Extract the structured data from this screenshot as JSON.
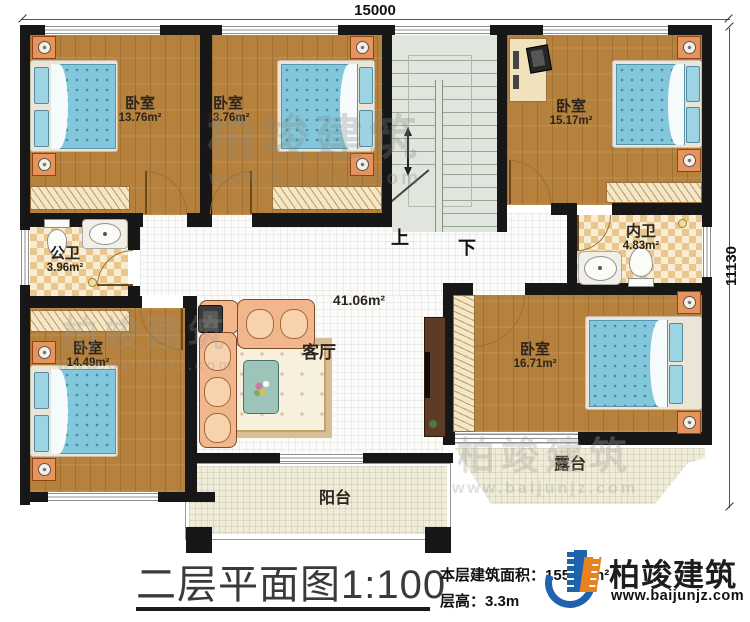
{
  "dimensions": {
    "width_label": "15000",
    "height_label": "11130"
  },
  "stairs": {
    "up": "上",
    "down": "下"
  },
  "rooms": {
    "bedroom_tl": {
      "label": "卧室",
      "area": "13.76m²"
    },
    "bedroom_tm": {
      "label": "卧室",
      "area": "13.76m²"
    },
    "bedroom_tr": {
      "label": "卧室",
      "area": "15.17m²"
    },
    "bath_public": {
      "label": "公卫",
      "area": "3.96m²"
    },
    "bath_inner": {
      "label": "内卫",
      "area": "4.83m²"
    },
    "bedroom_bl": {
      "label": "卧室",
      "area": "14.49m²"
    },
    "bedroom_br": {
      "label": "卧室",
      "area": "16.71m²"
    },
    "living": {
      "label": "客厅",
      "area": "41.06m²"
    },
    "balcony": {
      "label": "阳台"
    },
    "terrace": {
      "label": "露台"
    }
  },
  "footer": {
    "title": "二层平面图1:100",
    "floor_area_label": "本层建筑面积：",
    "floor_area_value": "155.12m²",
    "floor_height_label": "层高：",
    "floor_height_value": "3.3m"
  },
  "brand": {
    "name": "柏竣建筑",
    "website": "www.baijunjz.com"
  },
  "watermark": {
    "name": "柏竣建筑",
    "website": "www.baijunjz.com"
  }
}
